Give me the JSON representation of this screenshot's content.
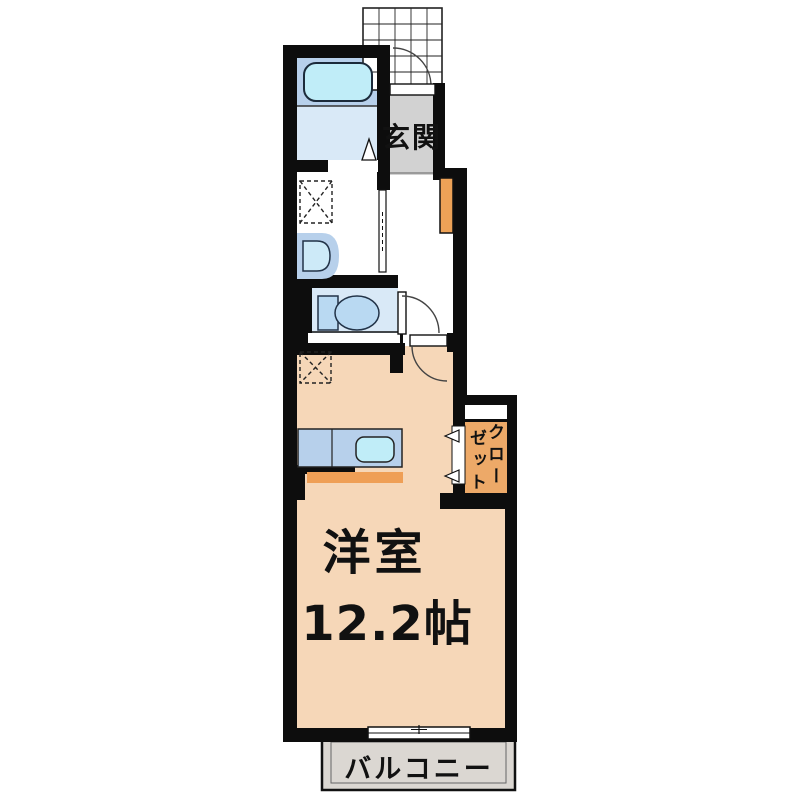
{
  "plan": {
    "type": "apartment-floorplan",
    "rooms": {
      "genkan": {
        "label": "玄関"
      },
      "main_room": {
        "label": "洋室",
        "size": "12.2帖"
      },
      "closet": {
        "label": "クローゼット",
        "label_col_right": "クロー",
        "label_col_left": "ゼット"
      },
      "balcony": {
        "label": "バルコニー"
      }
    }
  },
  "colors": {
    "wall": "#0d0d0d",
    "main_room": "#f6d7b8",
    "bath_upper": "#b7d0eb",
    "bath_floor": "#d9e9f7",
    "tub": "#c0edf8",
    "toilet_floor": "#d9e9f7",
    "fixture_blue": "#b9d9f2",
    "sink_outer": "#b7d0eb",
    "sink_basin": "#cdeaf8",
    "genkan_floor": "#d2d2d2",
    "shoe_cabinet": "#eda257",
    "closet_interior": "#eda968",
    "kitchen_counter": "#b7d0eb",
    "kitchen_sink": "#c0edf8",
    "kitchen_front": "#ef9f56",
    "balcony_floor": "#dbd7d2"
  }
}
